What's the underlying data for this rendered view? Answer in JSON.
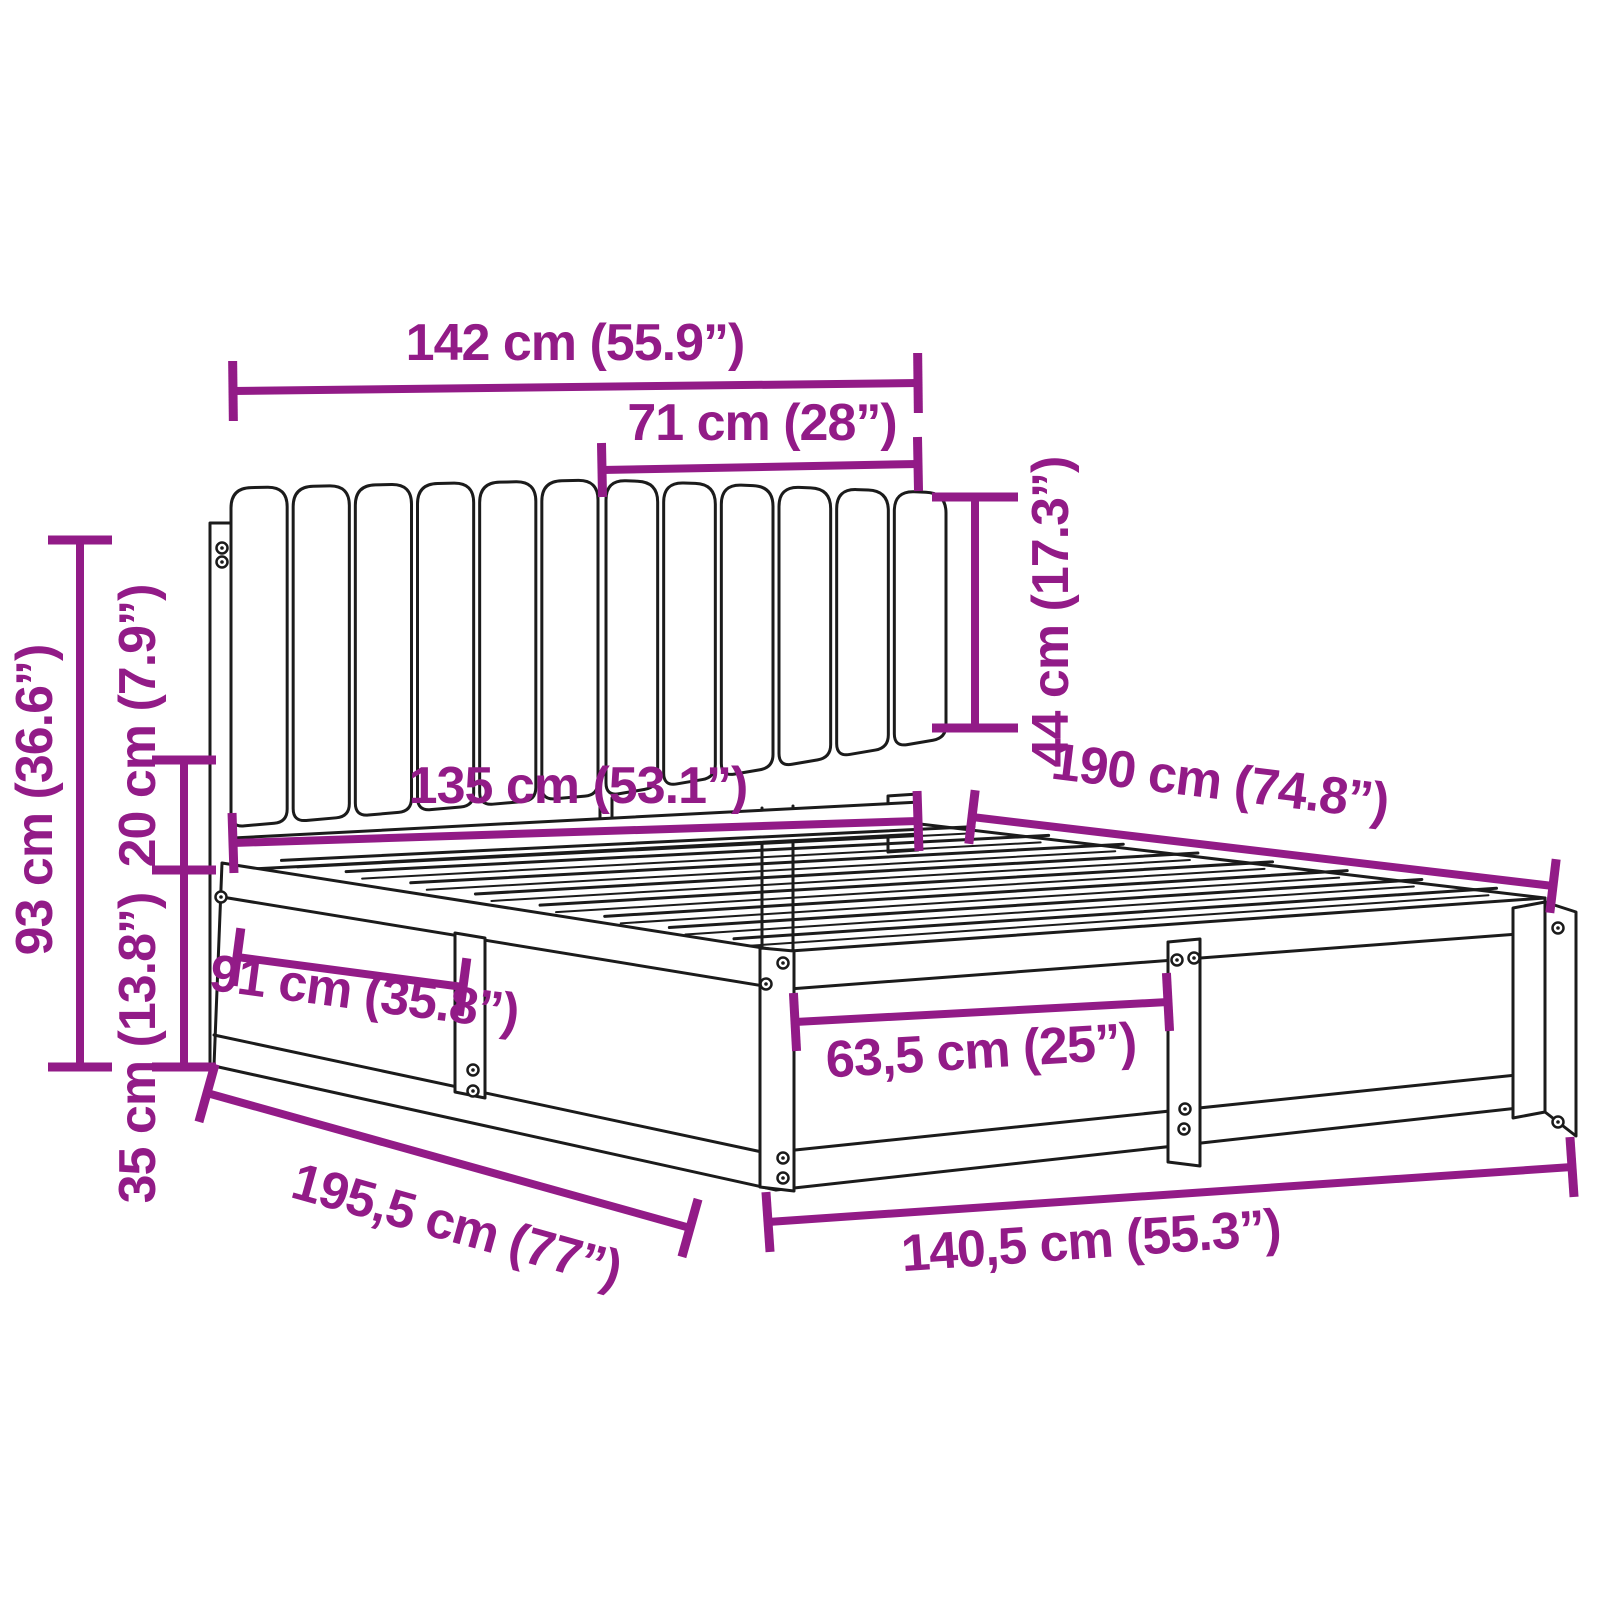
{
  "diagram": {
    "background": "#ffffff",
    "accent_color": "#921B87",
    "line_color": "#1b1b1b",
    "dimensions": {
      "headboard_width": "142 cm (55.9”)",
      "headboard_panel_width": "71 cm (28”)",
      "headboard_cushion_height": "44 cm (17.3”)",
      "headboard_total_height": "93 cm (36.6”)",
      "headboard_gap_height": "20 cm (7.9”)",
      "base_height": "35 cm (13.8”)",
      "inner_width": "135 cm (53.1”)",
      "mattress_length": "190 cm (74.8”)",
      "side_rail_section": "91 cm (35.8”)",
      "footboard_section": "63,5 cm (25”)",
      "total_length": "195,5 cm (77”)",
      "total_width": "140,5 cm (55.3”)"
    }
  }
}
